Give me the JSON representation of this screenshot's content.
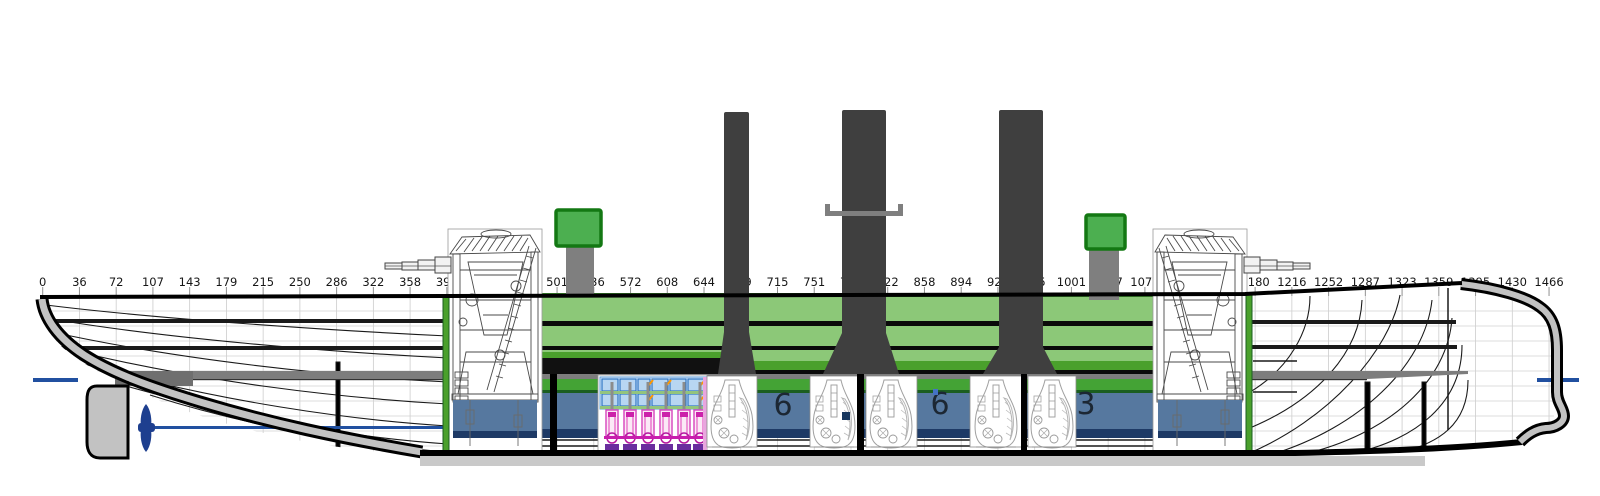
{
  "diagram": {
    "title": "ship-profile-technical-drawing",
    "view": "side elevation with internal machinery layout"
  },
  "ruler": {
    "labels": [
      "0",
      "36",
      "72",
      "107",
      "143",
      "179",
      "215",
      "250",
      "286",
      "322",
      "358",
      "394",
      "429",
      "465",
      "501",
      "536",
      "572",
      "608",
      "644",
      "679",
      "715",
      "751",
      "786",
      "822",
      "858",
      "894",
      "929",
      "965",
      "1001",
      "1037",
      "1073",
      "1108",
      "1144",
      "1180",
      "1216",
      "1252",
      "1287",
      "1323",
      "1359",
      "1395",
      "1430",
      "1466"
    ]
  },
  "hold_labels": {
    "bunker_1": "6",
    "bunker_2": "6",
    "bunker_3": "3"
  },
  "colors": {
    "funnel_dark": "#3f3f3f",
    "casemate_light_green": "#8cc878",
    "casemate_mid_green": "#4aa02c",
    "casemate_dark_green": "#3e8e2f",
    "ventilator_green": "#4caf50",
    "bunker_blue": "#56789f",
    "bunker_navy": "#1e3a66",
    "waterline_blue": "#2150a0",
    "armor_deck_gray": "#7d7d7d",
    "hull_shell_gray": "#c2c2c2",
    "engine_magenta": "#d94fc0",
    "engine_purple": "#6a2d9e",
    "engine_panel_blue": "#b8d6f2",
    "marker_red": "#e60000",
    "marker_navy": "#17365d"
  }
}
